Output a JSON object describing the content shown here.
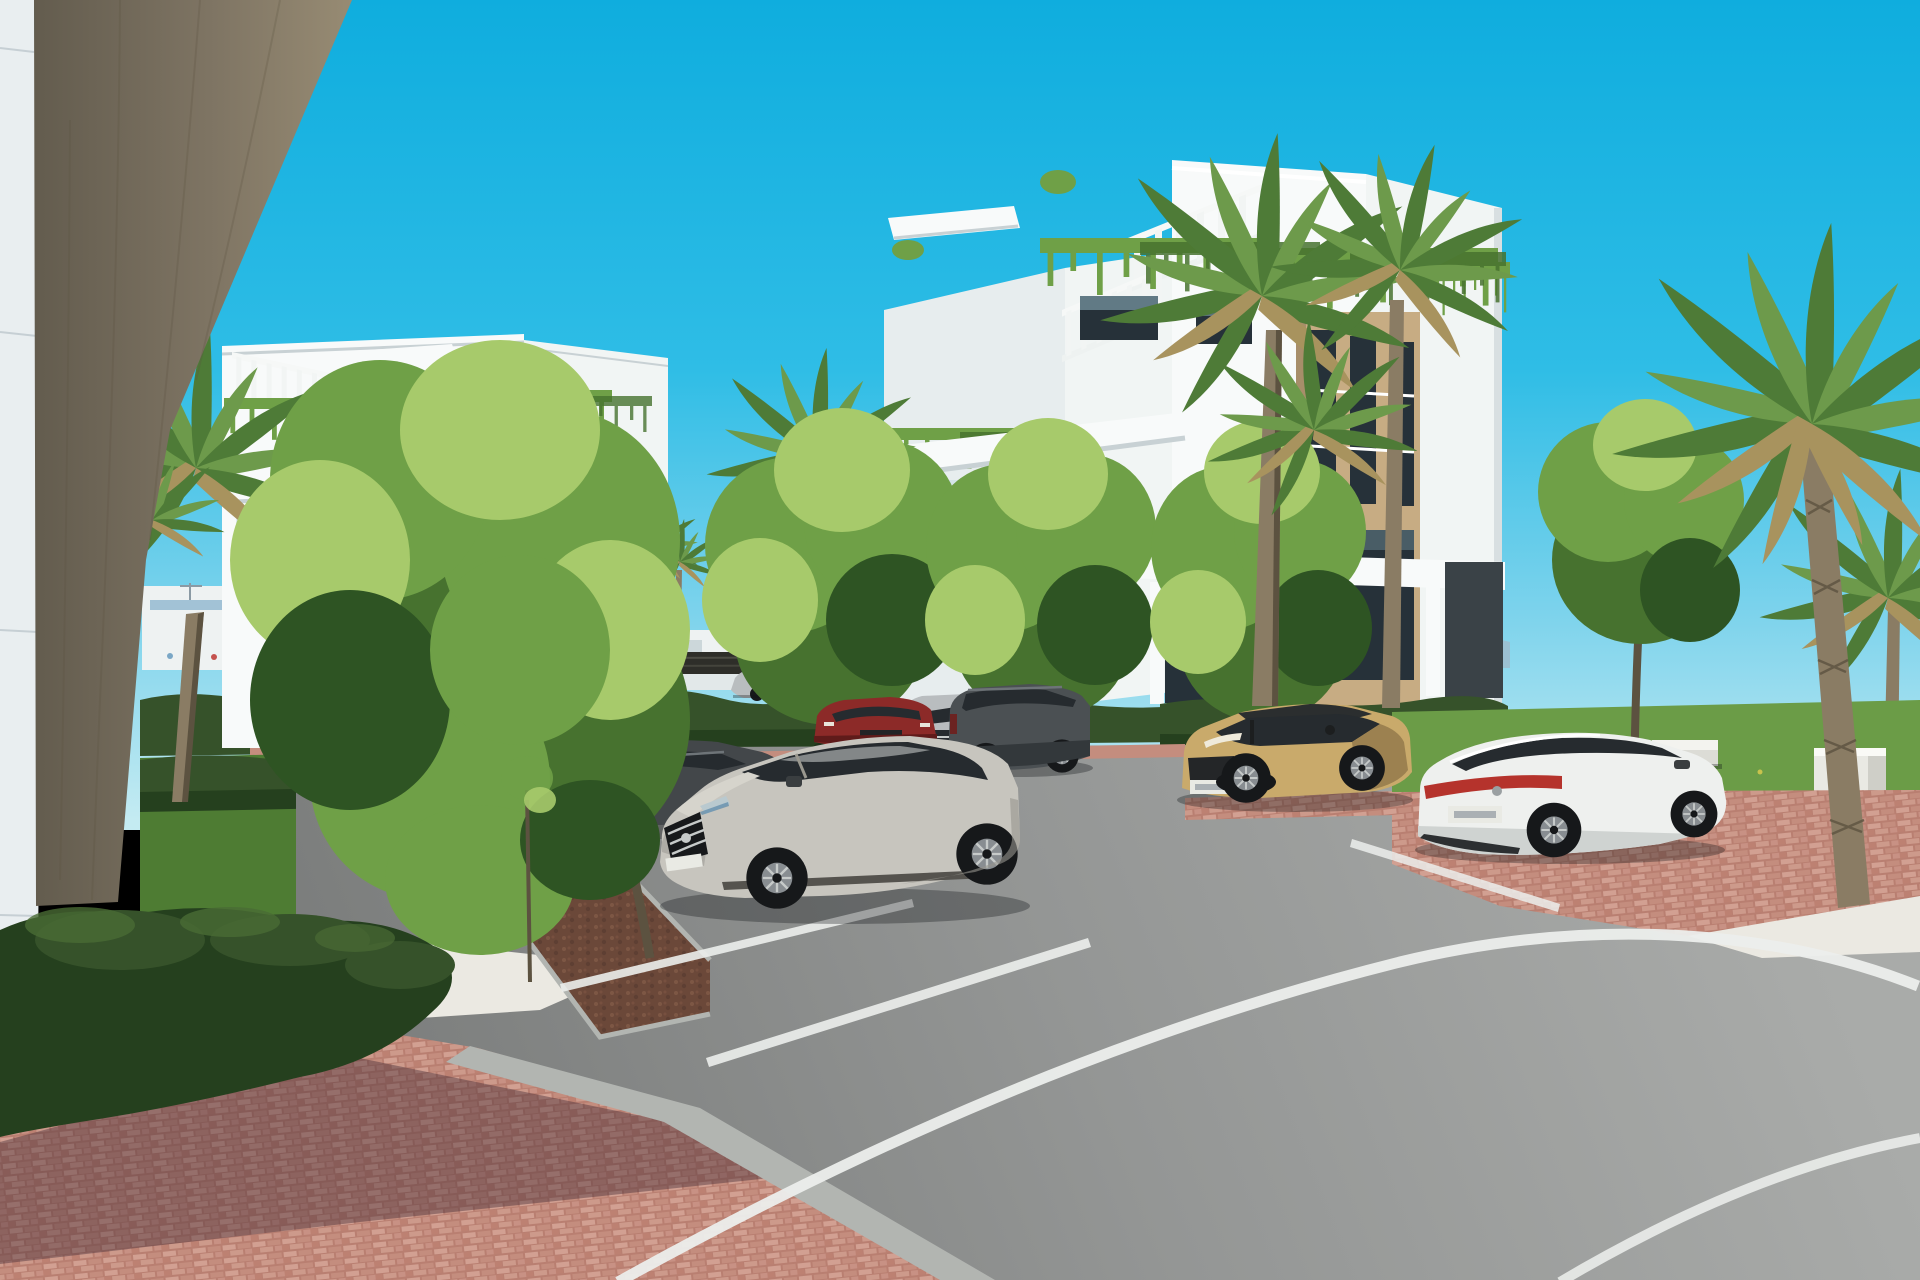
{
  "image": {
    "width": 1920,
    "height": 1280,
    "type": "3d-architectural-rendering",
    "description": "Sunny photorealistic rendering of a modern white apartment complex: two white residential blocks with roof pergolas and cascading balcony plants, palm trees, clipped hedges, red brick walkways, white gravel beds and a curved asphalt road with parked cars under a clear cyan sky."
  },
  "scene": {
    "sky": {
      "condition": "clear",
      "gradient": "deep cyan to pale horizon"
    },
    "background": {
      "mountains": true,
      "distant_white_city": true,
      "dark_slat_fence": true,
      "white_perimeter_wall": true,
      "construction_cranes": 2
    },
    "buildings": [
      {
        "name": "foreground-wall-and-column",
        "materials": [
          "white panel wall",
          "brown board-formed concrete column"
        ]
      },
      {
        "name": "left-apartment-block",
        "features": [
          "roof pergola",
          "hanging plants on parapet",
          "glass balcony",
          "tan stone accent",
          "dark windows"
        ]
      },
      {
        "name": "right-apartment-block",
        "features": [
          "stepped roof terraces",
          "two slatted pergolas",
          "cascading plants",
          "white balcony bands",
          "glass railings",
          "tan stone pier with tall dark windows",
          "charcoal ground-floor panels"
        ]
      }
    ],
    "amenities": {
      "white_parasol": 1,
      "sun_loungers": 3,
      "black_railing": true,
      "stone_bench": 1,
      "stone_pedestal": 1
    },
    "vegetation": {
      "fan_palms": 6,
      "deciduous_trees": 6,
      "saplings": 2,
      "hedges": "clipped boxwood rows",
      "lawns": 2
    },
    "ground": {
      "surfaces": [
        "red brick paver walkway",
        "white gravel beds",
        "asphalt parking",
        "curved asphalt road",
        "planter strip with soil"
      ],
      "markings": [
        "white parking bay lines",
        "long curved white road line",
        "second white line at bottom right"
      ],
      "shadow": "diagonal tree shadow across brick walkway"
    },
    "vehicles": [
      {
        "type": "sedan",
        "color": "dark-gray",
        "state": "parked",
        "position": "far-left behind tree"
      },
      {
        "type": "sedan",
        "color": "blue glimpse",
        "state": "parked",
        "position": "behind left sedan"
      },
      {
        "type": "sedan",
        "color": "dark-gray",
        "state": "parked",
        "position": "center-left"
      },
      {
        "type": "suv",
        "color": "silver",
        "state": "parked",
        "position": "center, front fascia visible"
      },
      {
        "type": "compact-suv",
        "color": "dark-red",
        "state": "parked",
        "position": "center"
      },
      {
        "type": "suv",
        "color": "graphite",
        "state": "parked",
        "position": "center-right"
      },
      {
        "type": "sedan",
        "color": "silver",
        "state": "driving",
        "position": "background road behind fence"
      },
      {
        "type": "suv-coupe",
        "color": "dusty-silver",
        "state": "parked",
        "position": "foreground center"
      },
      {
        "type": "compact-suv",
        "color": "sand-gold with black roof",
        "state": "parked",
        "position": "right of center"
      },
      {
        "type": "sedan",
        "color": "white with red light bar",
        "state": "parked",
        "position": "right"
      }
    ]
  },
  "palette": {
    "sky_top": "#0fadde",
    "sky_mid": "#2fbde6",
    "sky_low": "#7dd3ec",
    "sky_horizon": "#c4ebf2",
    "mountain": "#9fbccc",
    "mountain_far": "#c6dde6",
    "city_white": "#eef2f2",
    "city_shade": "#ccd7da",
    "city_blue": "#7aa7c6",
    "city_red": "#a2675d",
    "city_dark": "#54666f",
    "fence_dark": "#2e2e29",
    "wall_low": "#e2e8e9",
    "panel_white": "#e9eef0",
    "panel_seam": "#c6cfd4",
    "column_light": "#978b73",
    "column_mid": "#7e7463",
    "column_dark": "#635c4e",
    "bldg_sun": "#f8fafa",
    "bldg_lit": "#f1f5f4",
    "bldg_shade": "#e7edee",
    "soffit": "#c8d1d4",
    "stone_tan": "#c7ac83",
    "stone_tan_shade": "#a78e6a",
    "charcoal": "#3a4247",
    "glass_dark": "#263139",
    "glass_sky": "#9cc3d1",
    "glass_rail": "#bcd9e2",
    "hedge_dark": "#25401e",
    "hedge_mid": "#36522a",
    "hedge_light": "#4a6b34",
    "lawn_green": "#4e7c33",
    "lawn_bright": "#6b9c47",
    "leaf_bright": "#a7ca6b",
    "leaf_mid": "#6fa047",
    "leaf_dark": "#47722f",
    "leaf_deep": "#2e5423",
    "palm_green": "#4e7b37",
    "palm_light": "#6d9a4b",
    "palm_dry": "#a8935e",
    "bark": "#8a7c64",
    "bark_dark": "#5c5240",
    "brick_base": "#c48d7e",
    "brick_light": "#d2a092",
    "brick_gap": "#a06b60",
    "shadow_violet": "#3c2633",
    "gravel_white": "#ebe9e2",
    "planter_soil": "#6b4839",
    "curb_gray": "#b2b5b1",
    "asphalt_light": "#a9aba9",
    "asphalt_dark": "#7b7d7c",
    "line_white": "#eceeec",
    "car_dark": "#43474a",
    "car_graphite": "#4b5053",
    "car_window": "#262b2f",
    "car_silver": "#b9bdbf",
    "car_dusty": "#c7c5be",
    "car_dusty_shade": "#96948d",
    "car_red": "#8c2a28",
    "car_sand": "#c9aa6b",
    "car_sand_shade": "#9c8150",
    "car_black_roof": "#2b2e2f",
    "car_white": "#eef0ee",
    "car_white_shade": "#cfd3d1",
    "tail_red": "#b5332c",
    "tire_black": "#16181a",
    "rim_gray": "#888d91",
    "chrome": "#c6cac9",
    "plate_white": "#e9eae4",
    "shadow_black": "#101316"
  }
}
